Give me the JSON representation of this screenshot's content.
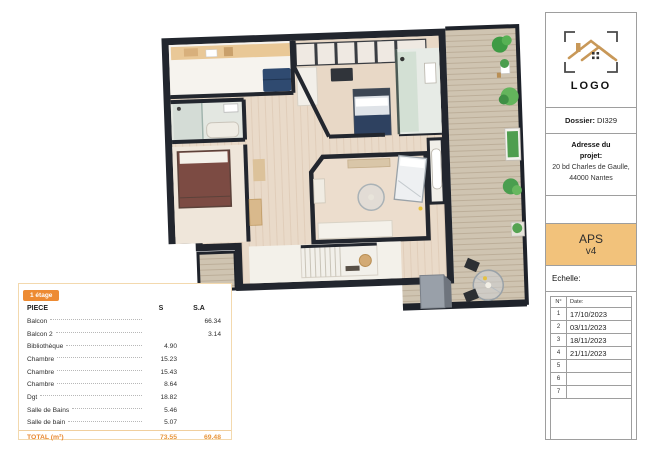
{
  "area_table": {
    "floor_badge": "1 étage",
    "columns": {
      "piece": "PIECE",
      "s": "S",
      "sa": "S.A"
    },
    "rows": [
      {
        "name": "Balcon",
        "s": "",
        "sa": "66.34"
      },
      {
        "name": "Balcon 2",
        "s": "",
        "sa": "3.14"
      },
      {
        "name": "Bibliothèque",
        "s": "4.90",
        "sa": ""
      },
      {
        "name": "Chambre",
        "s": "15.23",
        "sa": ""
      },
      {
        "name": "Chambre",
        "s": "15.43",
        "sa": ""
      },
      {
        "name": "Chambre",
        "s": "8.64",
        "sa": ""
      },
      {
        "name": "Dgt",
        "s": "18.82",
        "sa": ""
      },
      {
        "name": "Salle de Bains",
        "s": "5.46",
        "sa": ""
      },
      {
        "name": "Salle de bain",
        "s": "5.07",
        "sa": ""
      }
    ],
    "total": {
      "label": "TOTAL (m²)",
      "s": "73.55",
      "sa": "69.48"
    }
  },
  "title_block": {
    "logo_text": "LOGO",
    "dossier_label": "Dossier:",
    "dossier_value": "DI329",
    "address_label": "Adresse du projet:",
    "address_value": "20 bd Charles de Gaulle, 44000 Nantes",
    "phase": "APS",
    "version": "v4",
    "scale_label": "Echelle:",
    "revisions": {
      "col_no": "N°",
      "col_date": "Date:",
      "rows": [
        {
          "no": "1",
          "date": "17/10/2023"
        },
        {
          "no": "2",
          "date": "03/11/2023"
        },
        {
          "no": "3",
          "date": "18/11/2023"
        },
        {
          "no": "4",
          "date": "21/11/2023"
        },
        {
          "no": "5",
          "date": ""
        },
        {
          "no": "6",
          "date": ""
        },
        {
          "no": "7",
          "date": ""
        }
      ]
    }
  },
  "colors": {
    "badge_orange": "#ed8b33",
    "total_orange": "#e8963c",
    "aps_background": "#f2c27b",
    "wall_black": "#22262e",
    "interior_wood": "#e9dac9",
    "deck_wood": "#cfc4b1",
    "plant_green": "#4a9e4f",
    "logo_tan": "#c89858"
  }
}
